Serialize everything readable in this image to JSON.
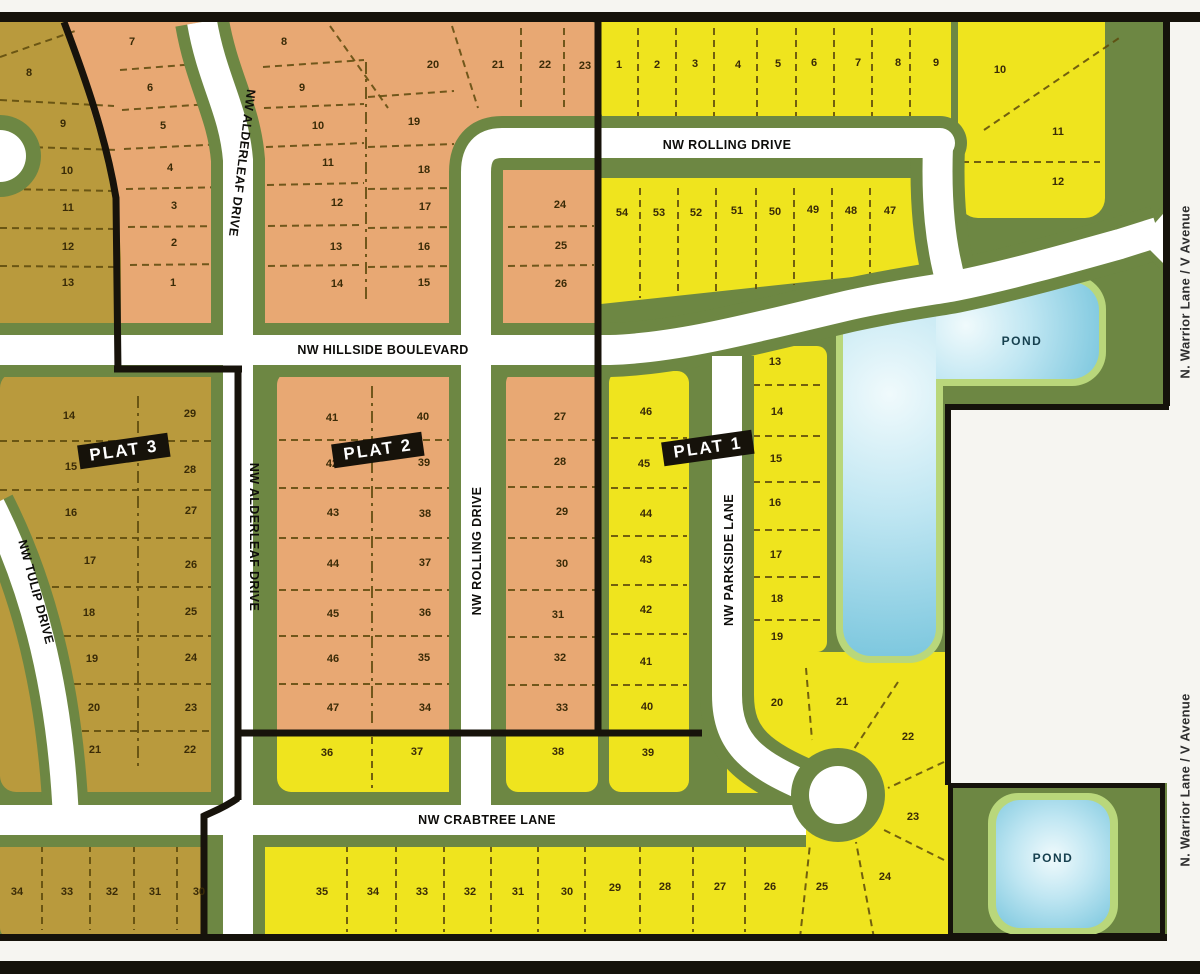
{
  "colors": {
    "yellow": "#efe41e",
    "orange": "#e8a873",
    "olive": "#b99a3d",
    "green": "#6d8743",
    "pond_ring": "#b9d77b",
    "pond_blue": "#7cc7de",
    "road": "#ffffff",
    "boundary": "#17130b"
  },
  "plat_labels": [
    {
      "text": "PLAT 1",
      "x": 708,
      "y": 448,
      "rot": -8
    },
    {
      "text": "PLAT 2",
      "x": 378,
      "y": 450,
      "rot": -8
    },
    {
      "text": "PLAT 3",
      "x": 124,
      "y": 451,
      "rot": -8
    }
  ],
  "street_labels": [
    {
      "text": "NW ROLLING DRIVE",
      "x": 727,
      "y": 145,
      "rot": 0
    },
    {
      "text": "NW HILLSIDE BOULEVARD",
      "x": 383,
      "y": 350,
      "rot": 0
    },
    {
      "text": "NW CRABTREE LANE",
      "x": 487,
      "y": 820,
      "rot": 0
    },
    {
      "text": "NW ALDERLEAF DRIVE",
      "x": 242,
      "y": 163,
      "rot": 97
    },
    {
      "text": "NW ALDERLEAF DRIVE",
      "x": 254,
      "y": 537,
      "rot": 90
    },
    {
      "text": "NW ROLLING DRIVE",
      "x": 477,
      "y": 551,
      "rot": -90
    },
    {
      "text": "NW PARKSIDE LANE",
      "x": 729,
      "y": 560,
      "rot": -90
    },
    {
      "text": "NW TULIP DRIVE",
      "x": 36,
      "y": 592,
      "rot": 75
    },
    {
      "text": "N. Warrior Lane / V Avenue",
      "x": 1185,
      "y": 292,
      "rot": -90,
      "style": "warrior"
    },
    {
      "text": "N. Warrior Lane / V Avenue",
      "x": 1185,
      "y": 780,
      "rot": -90,
      "style": "warrior"
    }
  ],
  "pond_labels": [
    {
      "text": "POND",
      "x": 1022,
      "y": 341
    },
    {
      "text": "POND",
      "x": 1053,
      "y": 858
    }
  ],
  "lots": [
    {
      "n": "8",
      "x": 29,
      "y": 73,
      "area": "plat3-north"
    },
    {
      "n": "9",
      "x": 63,
      "y": 124,
      "area": "plat3-north"
    },
    {
      "n": "10",
      "x": 67,
      "y": 171,
      "area": "plat3-north"
    },
    {
      "n": "11",
      "x": 68,
      "y": 208,
      "area": "plat3-north"
    },
    {
      "n": "12",
      "x": 68,
      "y": 247,
      "area": "plat3-north"
    },
    {
      "n": "13",
      "x": 68,
      "y": 283,
      "area": "plat3-north"
    },
    {
      "n": "7",
      "x": 132,
      "y": 42,
      "area": "plat2-west"
    },
    {
      "n": "6",
      "x": 150,
      "y": 88,
      "area": "plat2-west"
    },
    {
      "n": "5",
      "x": 163,
      "y": 126,
      "area": "plat2-west"
    },
    {
      "n": "4",
      "x": 170,
      "y": 168,
      "area": "plat2-west"
    },
    {
      "n": "3",
      "x": 174,
      "y": 206,
      "area": "plat2-west"
    },
    {
      "n": "2",
      "x": 174,
      "y": 243,
      "area": "plat2-west"
    },
    {
      "n": "1",
      "x": 173,
      "y": 283,
      "area": "plat2-west"
    },
    {
      "n": "8",
      "x": 284,
      "y": 42,
      "area": "plat2-north"
    },
    {
      "n": "9",
      "x": 302,
      "y": 88,
      "area": "plat2-north"
    },
    {
      "n": "10",
      "x": 318,
      "y": 126,
      "area": "plat2-north"
    },
    {
      "n": "11",
      "x": 328,
      "y": 163,
      "area": "plat2-north"
    },
    {
      "n": "12",
      "x": 337,
      "y": 203,
      "area": "plat2-north"
    },
    {
      "n": "13",
      "x": 336,
      "y": 247,
      "area": "plat2-north"
    },
    {
      "n": "14",
      "x": 337,
      "y": 284,
      "area": "plat2-north"
    },
    {
      "n": "20",
      "x": 433,
      "y": 65,
      "area": "plat2-north"
    },
    {
      "n": "19",
      "x": 414,
      "y": 122,
      "area": "plat2-north"
    },
    {
      "n": "18",
      "x": 424,
      "y": 170,
      "area": "plat2-north"
    },
    {
      "n": "17",
      "x": 425,
      "y": 207,
      "area": "plat2-north"
    },
    {
      "n": "16",
      "x": 424,
      "y": 247,
      "area": "plat2-north"
    },
    {
      "n": "15",
      "x": 424,
      "y": 283,
      "area": "plat2-north"
    },
    {
      "n": "21",
      "x": 498,
      "y": 65,
      "area": "plat2-north"
    },
    {
      "n": "22",
      "x": 545,
      "y": 65,
      "area": "plat2-north"
    },
    {
      "n": "23",
      "x": 585,
      "y": 66,
      "area": "plat2-north"
    },
    {
      "n": "24",
      "x": 560,
      "y": 205,
      "area": "plat2-north"
    },
    {
      "n": "25",
      "x": 561,
      "y": 246,
      "area": "plat2-north"
    },
    {
      "n": "26",
      "x": 561,
      "y": 284,
      "area": "plat2-north"
    },
    {
      "n": "1",
      "x": 619,
      "y": 65,
      "area": "plat1-north"
    },
    {
      "n": "2",
      "x": 657,
      "y": 65,
      "area": "plat1-north"
    },
    {
      "n": "3",
      "x": 695,
      "y": 64,
      "area": "plat1-north"
    },
    {
      "n": "4",
      "x": 738,
      "y": 65,
      "area": "plat1-north"
    },
    {
      "n": "5",
      "x": 778,
      "y": 64,
      "area": "plat1-north"
    },
    {
      "n": "6",
      "x": 814,
      "y": 63,
      "area": "plat1-north"
    },
    {
      "n": "7",
      "x": 858,
      "y": 63,
      "area": "plat1-north"
    },
    {
      "n": "8",
      "x": 898,
      "y": 63,
      "area": "plat1-north"
    },
    {
      "n": "9",
      "x": 936,
      "y": 63,
      "area": "plat1-north"
    },
    {
      "n": "10",
      "x": 1000,
      "y": 70,
      "area": "plat1-north"
    },
    {
      "n": "11",
      "x": 1058,
      "y": 132,
      "area": "plat1-north"
    },
    {
      "n": "12",
      "x": 1058,
      "y": 182,
      "area": "plat1-north"
    },
    {
      "n": "54",
      "x": 622,
      "y": 213,
      "area": "plat1-north"
    },
    {
      "n": "53",
      "x": 659,
      "y": 213,
      "area": "plat1-north"
    },
    {
      "n": "52",
      "x": 696,
      "y": 213,
      "area": "plat1-north"
    },
    {
      "n": "51",
      "x": 737,
      "y": 211,
      "area": "plat1-north"
    },
    {
      "n": "50",
      "x": 775,
      "y": 212,
      "area": "plat1-north"
    },
    {
      "n": "49",
      "x": 813,
      "y": 210,
      "area": "plat1-north"
    },
    {
      "n": "48",
      "x": 851,
      "y": 211,
      "area": "plat1-north"
    },
    {
      "n": "47",
      "x": 890,
      "y": 211,
      "area": "plat1-north"
    },
    {
      "n": "41",
      "x": 332,
      "y": 418,
      "area": "plat2"
    },
    {
      "n": "42",
      "x": 332,
      "y": 464,
      "area": "plat2"
    },
    {
      "n": "43",
      "x": 333,
      "y": 513,
      "area": "plat2"
    },
    {
      "n": "44",
      "x": 333,
      "y": 564,
      "area": "plat2"
    },
    {
      "n": "45",
      "x": 333,
      "y": 614,
      "area": "plat2"
    },
    {
      "n": "46",
      "x": 333,
      "y": 659,
      "area": "plat2"
    },
    {
      "n": "47",
      "x": 333,
      "y": 708,
      "area": "plat2"
    },
    {
      "n": "40",
      "x": 423,
      "y": 417,
      "area": "plat2"
    },
    {
      "n": "39",
      "x": 424,
      "y": 463,
      "area": "plat2"
    },
    {
      "n": "38",
      "x": 425,
      "y": 514,
      "area": "plat2"
    },
    {
      "n": "37",
      "x": 425,
      "y": 563,
      "area": "plat2"
    },
    {
      "n": "36",
      "x": 425,
      "y": 613,
      "area": "plat2"
    },
    {
      "n": "35",
      "x": 424,
      "y": 658,
      "area": "plat2"
    },
    {
      "n": "34",
      "x": 425,
      "y": 708,
      "area": "plat2"
    },
    {
      "n": "27",
      "x": 560,
      "y": 417,
      "area": "plat2"
    },
    {
      "n": "28",
      "x": 560,
      "y": 462,
      "area": "plat2"
    },
    {
      "n": "29",
      "x": 562,
      "y": 512,
      "area": "plat2"
    },
    {
      "n": "30",
      "x": 562,
      "y": 564,
      "area": "plat2"
    },
    {
      "n": "31",
      "x": 558,
      "y": 615,
      "area": "plat2"
    },
    {
      "n": "32",
      "x": 560,
      "y": 658,
      "area": "plat2"
    },
    {
      "n": "33",
      "x": 562,
      "y": 708,
      "area": "plat2"
    },
    {
      "n": "46",
      "x": 646,
      "y": 412,
      "area": "plat1"
    },
    {
      "n": "45",
      "x": 644,
      "y": 464,
      "area": "plat1"
    },
    {
      "n": "44",
      "x": 646,
      "y": 514,
      "area": "plat1"
    },
    {
      "n": "43",
      "x": 646,
      "y": 560,
      "area": "plat1"
    },
    {
      "n": "42",
      "x": 646,
      "y": 610,
      "area": "plat1"
    },
    {
      "n": "41",
      "x": 646,
      "y": 662,
      "area": "plat1"
    },
    {
      "n": "40",
      "x": 647,
      "y": 707,
      "area": "plat1"
    },
    {
      "n": "39",
      "x": 648,
      "y": 753,
      "area": "plat1"
    },
    {
      "n": "13",
      "x": 775,
      "y": 362,
      "area": "plat1"
    },
    {
      "n": "14",
      "x": 777,
      "y": 412,
      "area": "plat1"
    },
    {
      "n": "15",
      "x": 776,
      "y": 459,
      "area": "plat1"
    },
    {
      "n": "16",
      "x": 775,
      "y": 503,
      "area": "plat1"
    },
    {
      "n": "17",
      "x": 776,
      "y": 555,
      "area": "plat1"
    },
    {
      "n": "18",
      "x": 777,
      "y": 599,
      "area": "plat1"
    },
    {
      "n": "19",
      "x": 777,
      "y": 637,
      "area": "plat1"
    },
    {
      "n": "20",
      "x": 777,
      "y": 703,
      "area": "plat1"
    },
    {
      "n": "21",
      "x": 842,
      "y": 702,
      "area": "plat1"
    },
    {
      "n": "22",
      "x": 908,
      "y": 737,
      "area": "plat1"
    },
    {
      "n": "23",
      "x": 913,
      "y": 817,
      "area": "plat1"
    },
    {
      "n": "24",
      "x": 885,
      "y": 877,
      "area": "plat1"
    },
    {
      "n": "36",
      "x": 327,
      "y": 753,
      "area": "plat1-crabtree"
    },
    {
      "n": "37",
      "x": 417,
      "y": 752,
      "area": "plat1-crabtree"
    },
    {
      "n": "38",
      "x": 558,
      "y": 752,
      "area": "plat1-crabtree"
    },
    {
      "n": "35",
      "x": 322,
      "y": 892,
      "area": "plat1-south"
    },
    {
      "n": "34",
      "x": 373,
      "y": 892,
      "area": "plat1-south"
    },
    {
      "n": "33",
      "x": 422,
      "y": 892,
      "area": "plat1-south"
    },
    {
      "n": "32",
      "x": 470,
      "y": 892,
      "area": "plat1-south"
    },
    {
      "n": "31",
      "x": 518,
      "y": 892,
      "area": "plat1-south"
    },
    {
      "n": "30",
      "x": 567,
      "y": 892,
      "area": "plat1-south"
    },
    {
      "n": "29",
      "x": 615,
      "y": 888,
      "area": "plat1-south"
    },
    {
      "n": "28",
      "x": 665,
      "y": 887,
      "area": "plat1-south"
    },
    {
      "n": "27",
      "x": 720,
      "y": 887,
      "area": "plat1-south"
    },
    {
      "n": "26",
      "x": 770,
      "y": 887,
      "area": "plat1-south"
    },
    {
      "n": "25",
      "x": 822,
      "y": 887,
      "area": "plat1-south"
    },
    {
      "n": "14",
      "x": 69,
      "y": 416,
      "area": "plat3"
    },
    {
      "n": "29",
      "x": 190,
      "y": 414,
      "area": "plat3"
    },
    {
      "n": "15",
      "x": 71,
      "y": 467,
      "area": "plat3"
    },
    {
      "n": "28",
      "x": 190,
      "y": 470,
      "area": "plat3"
    },
    {
      "n": "16",
      "x": 71,
      "y": 513,
      "area": "plat3"
    },
    {
      "n": "27",
      "x": 191,
      "y": 511,
      "area": "plat3"
    },
    {
      "n": "17",
      "x": 90,
      "y": 561,
      "area": "plat3"
    },
    {
      "n": "26",
      "x": 191,
      "y": 565,
      "area": "plat3"
    },
    {
      "n": "18",
      "x": 89,
      "y": 613,
      "area": "plat3"
    },
    {
      "n": "25",
      "x": 191,
      "y": 612,
      "area": "plat3"
    },
    {
      "n": "19",
      "x": 92,
      "y": 659,
      "area": "plat3"
    },
    {
      "n": "24",
      "x": 191,
      "y": 658,
      "area": "plat3"
    },
    {
      "n": "20",
      "x": 94,
      "y": 708,
      "area": "plat3"
    },
    {
      "n": "23",
      "x": 191,
      "y": 708,
      "area": "plat3"
    },
    {
      "n": "21",
      "x": 95,
      "y": 750,
      "area": "plat3"
    },
    {
      "n": "22",
      "x": 190,
      "y": 750,
      "area": "plat3"
    },
    {
      "n": "34",
      "x": 17,
      "y": 892,
      "area": "plat3-south"
    },
    {
      "n": "33",
      "x": 67,
      "y": 892,
      "area": "plat3-south"
    },
    {
      "n": "32",
      "x": 112,
      "y": 892,
      "area": "plat3-south"
    },
    {
      "n": "31",
      "x": 155,
      "y": 892,
      "area": "plat3-south"
    },
    {
      "n": "30",
      "x": 199,
      "y": 892,
      "area": "plat3-south"
    }
  ]
}
